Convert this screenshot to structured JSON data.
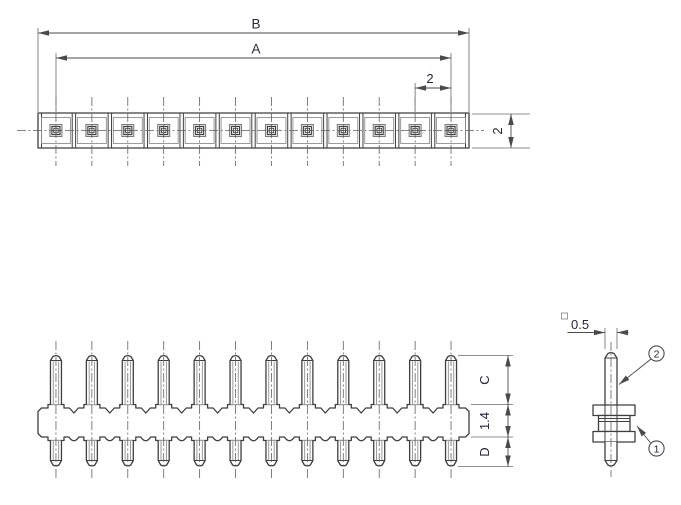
{
  "diagram": {
    "pin_count": 12,
    "top_view": {
      "dim_overall": "B",
      "dim_pin_span": "A",
      "dim_pitch": "2",
      "dim_width": "2"
    },
    "front_view": {
      "dim_pin_top": "C",
      "dim_body": "1.4",
      "dim_pin_bottom": "D"
    },
    "side_view": {
      "dim_pin_square": "0.5",
      "callout_pin": "2",
      "callout_body": "1"
    }
  }
}
